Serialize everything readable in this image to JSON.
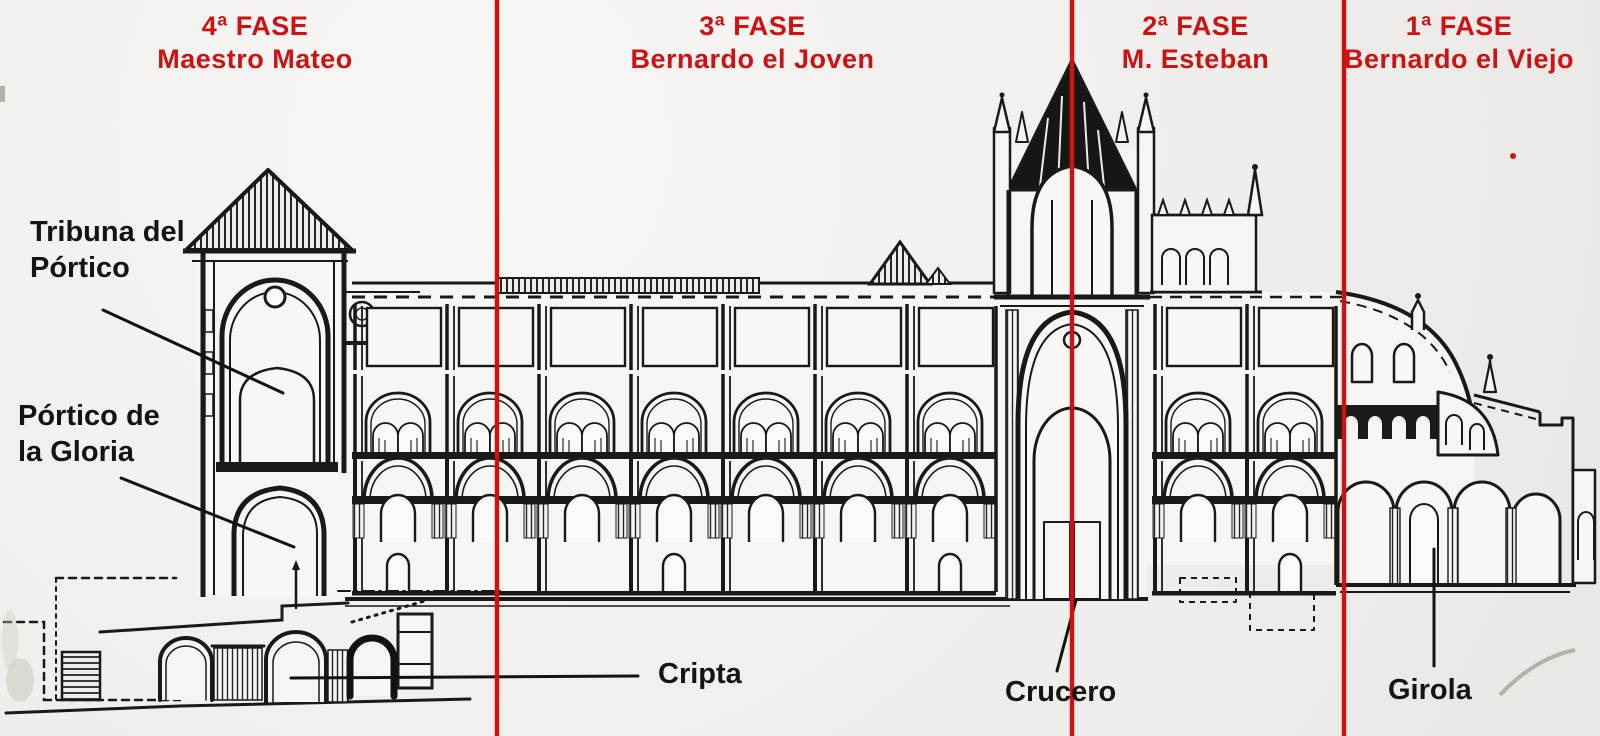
{
  "phases": [
    {
      "fase": "4ª FASE",
      "author": "Maestro Mateo"
    },
    {
      "fase": "3ª FASE",
      "author": "Bernardo el Joven"
    },
    {
      "fase": "2ª FASE",
      "author": "M. Esteban"
    },
    {
      "fase": "1ª FASE",
      "author": "Bernardo el Viejo"
    }
  ],
  "part_labels": {
    "tribuna": [
      "Tribuna del",
      "Pórtico"
    ],
    "portico": [
      "Pórtico de",
      "la Gloria"
    ],
    "cripta": "Cripta",
    "crucero": "Crucero",
    "girola": "Girola"
  },
  "colors": {
    "phase_red": "#ce1113",
    "ink": "#1b1917",
    "paper": "#f1efeb"
  }
}
